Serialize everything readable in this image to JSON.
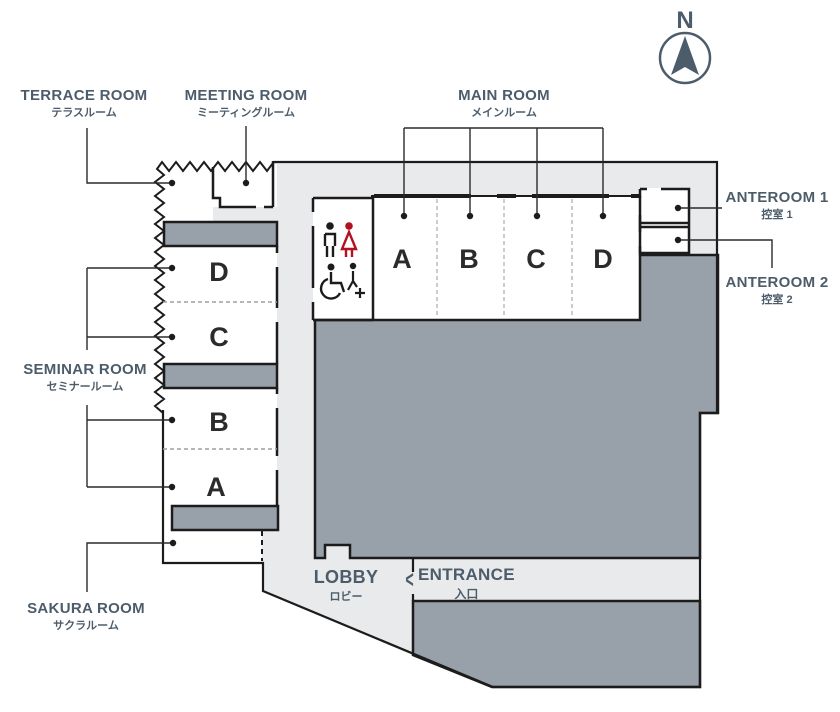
{
  "compass": {
    "label": "N"
  },
  "labels": {
    "terrace": {
      "en": "TERRACE ROOM",
      "ja": "テラスルーム"
    },
    "meeting": {
      "en": "MEETING ROOM",
      "ja": "ミーティングルーム"
    },
    "main": {
      "en": "MAIN ROOM",
      "ja": "メインルーム"
    },
    "anteroom1": {
      "en": "ANTEROOM 1",
      "ja": "控室 1"
    },
    "anteroom2": {
      "en": "ANTEROOM 2",
      "ja": "控室 2"
    },
    "seminar": {
      "en": "SEMINAR ROOM",
      "ja": "セミナールーム"
    },
    "sakura": {
      "en": "SAKURA ROOM",
      "ja": "サクラルーム"
    },
    "lobby": {
      "en": "LOBBY",
      "ja": "ロビー"
    },
    "entrance": {
      "en": "ENTRANCE",
      "ja": "入口",
      "arrow": "<"
    }
  },
  "rooms": {
    "main_sections": [
      "A",
      "B",
      "C",
      "D"
    ],
    "seminar_sections": [
      "D",
      "C",
      "B",
      "A"
    ]
  },
  "icons": {
    "restroom": [
      "male-icon",
      "female-icon",
      "wheelchair-icon",
      "accessible-plus-icon"
    ]
  },
  "colors": {
    "floor_light": "#e9eaec",
    "floor_dark": "#98a0a9",
    "wall": "#1c1c1c",
    "label_text": "#4d5c6a",
    "female_icon": "#b0121f"
  }
}
